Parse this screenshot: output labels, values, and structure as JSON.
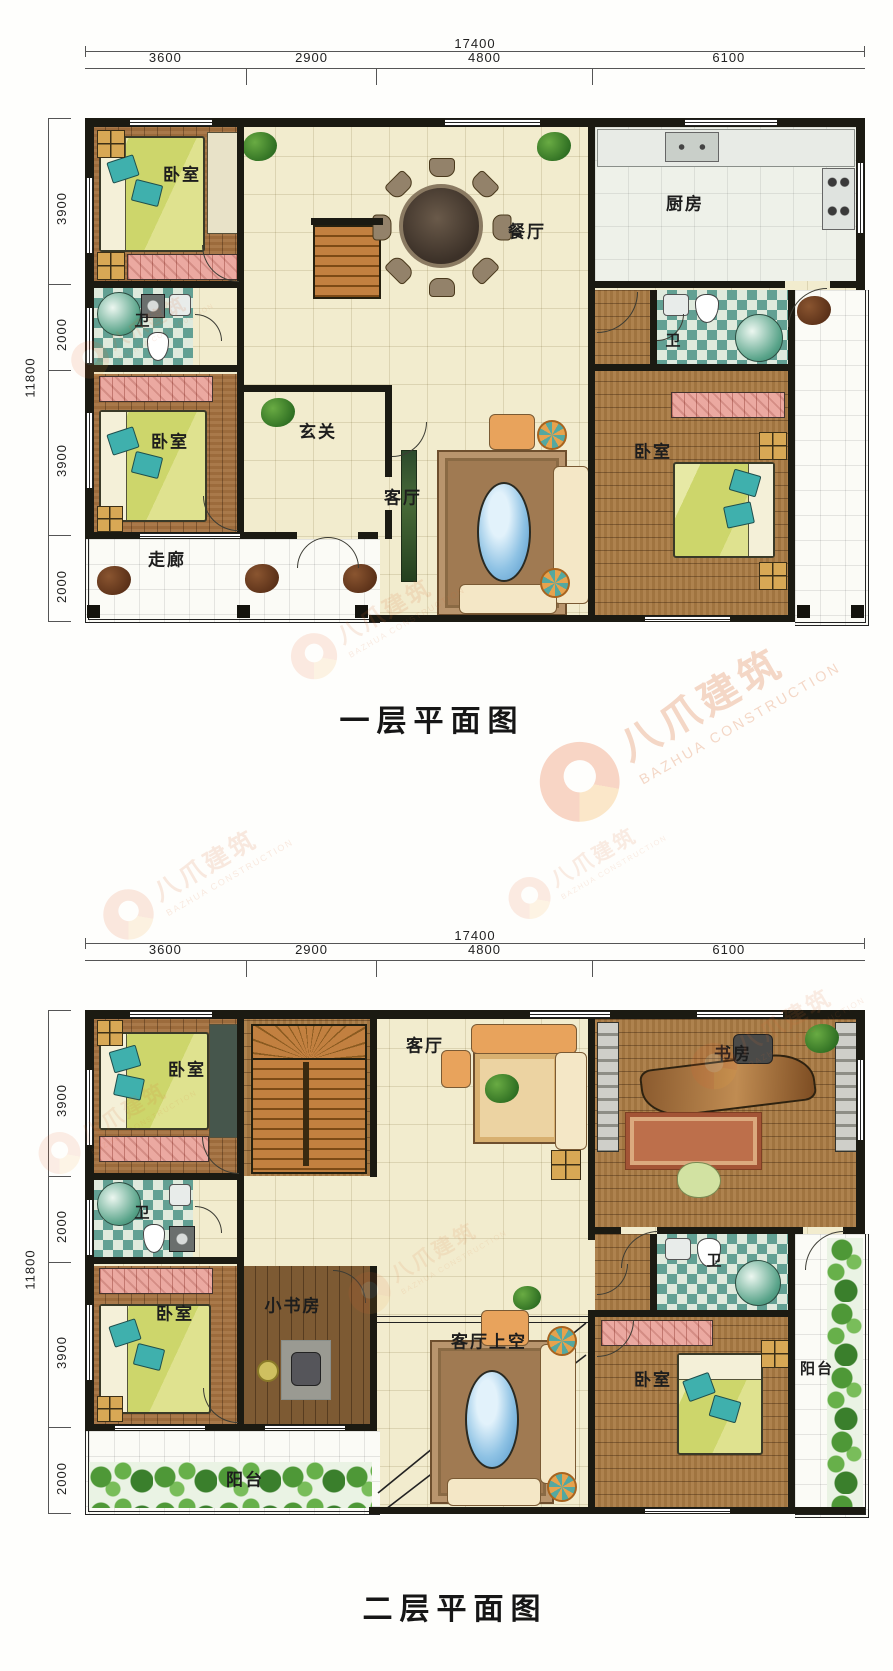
{
  "watermark": {
    "name": "八爪建筑",
    "name_en": "BAZHUA CONSTRUCTION"
  },
  "dims": {
    "top_total": "17400",
    "top_segments": [
      "3600",
      "2900",
      "4800",
      "6100"
    ],
    "left_total": "11800",
    "left_segments": [
      "3900",
      "2000",
      "3900",
      "2000"
    ]
  },
  "floor1": {
    "title": "一层平面图",
    "rooms": {
      "bedroom_tl": "卧室",
      "bath_l": "卫",
      "bedroom_ml": "卧室",
      "corridor": "走廊",
      "dining": "餐厅",
      "entry": "玄关",
      "living": "客厅",
      "kitchen": "厨房",
      "bath_r": "卫",
      "bedroom_r": "卧室"
    }
  },
  "floor2": {
    "title": "二层平面图",
    "rooms": {
      "bedroom_tl": "卧室",
      "living": "客厅",
      "study": "书房",
      "bath_l": "卫",
      "bedroom_bl": "卧室",
      "small_study": "小书房",
      "living_void": "客厅上空",
      "bath_r": "卫",
      "bedroom_br": "卧室",
      "balcony_l": "阳台",
      "balcony_r": "阳台"
    }
  },
  "colors": {
    "wall": "#1b1a12",
    "cream_tile": "#f2ecce",
    "wood": "#a4713f",
    "bath_teal": "#62a093",
    "bed_green": "#cdd66b",
    "pillow_teal": "#3fb0ad",
    "accent_orange": "#e8622a",
    "pool_blue": "#8ec2e4",
    "plant_green": "#4e9837"
  }
}
